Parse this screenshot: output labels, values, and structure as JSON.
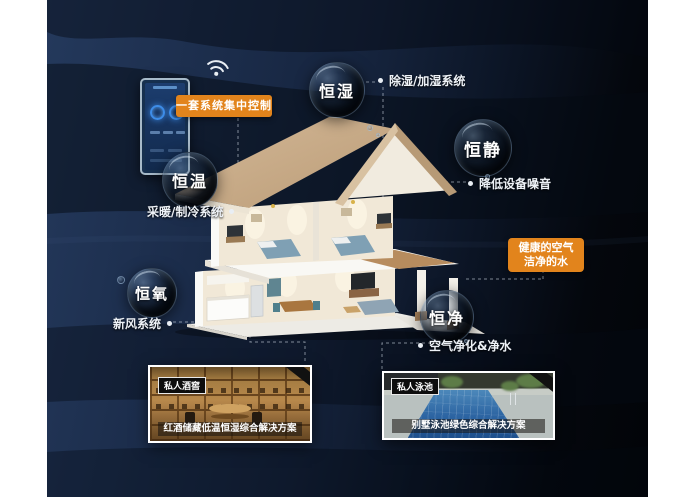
{
  "scene": {
    "control": {
      "label": "一套系统集中控制"
    },
    "highlight_box": {
      "line1": "健康的空气",
      "line2": "洁净的水"
    },
    "bubbles": [
      {
        "id": "heng-shi",
        "label": "恒湿",
        "note": "除湿/加湿系统"
      },
      {
        "id": "heng-jing",
        "label": "恒静",
        "note": "降低设备噪音"
      },
      {
        "id": "heng-wen",
        "label": "恒温",
        "note": "采暖/制冷系统"
      },
      {
        "id": "heng-yang",
        "label": "恒氧",
        "note": "新风系统"
      },
      {
        "id": "heng-jin",
        "label": "恒净",
        "note": "空气净化&净水"
      }
    ],
    "cards": [
      {
        "badge": "私人酒窖",
        "caption": "红酒储藏低温恒湿综合解决方案"
      },
      {
        "badge": "私人泳池",
        "caption": "别墅泳池绿色综合解决方案"
      }
    ],
    "icons": {
      "wifi": "wifi-icon",
      "phone": "smart-control-phone"
    },
    "colors": {
      "accent_orange": "#E2841C",
      "background_navy": "#1B2C4A",
      "background_dark": "#04070D",
      "bubble_text": "#FFFFFF"
    }
  }
}
